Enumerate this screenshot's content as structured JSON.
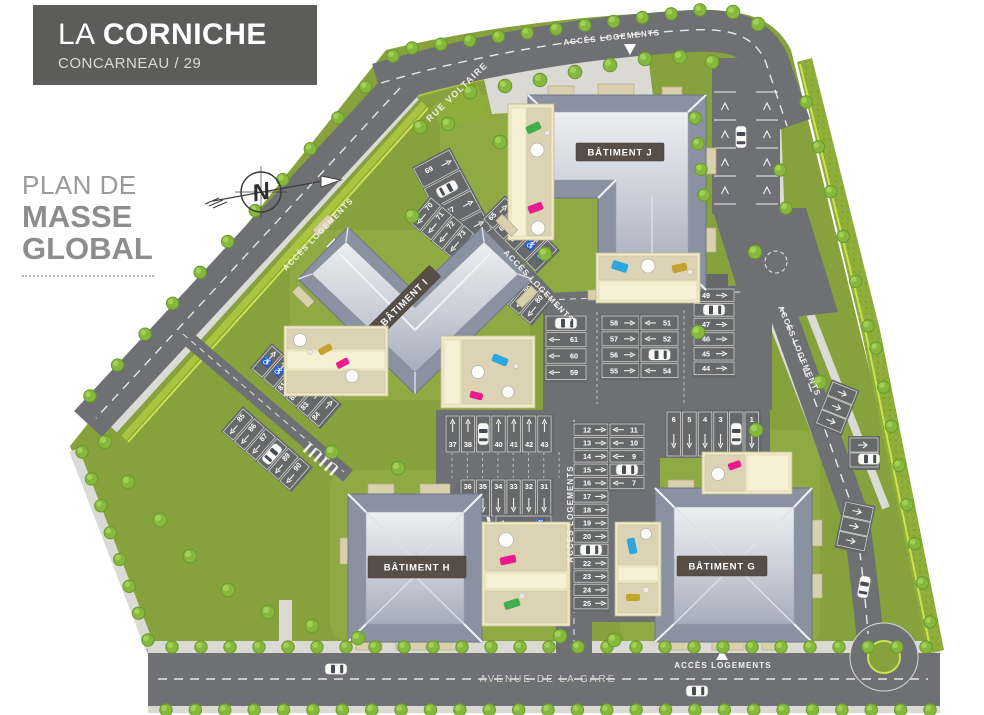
{
  "palette": {
    "grass": "#87a13c",
    "road": "#6f7073",
    "lot": "#66686a",
    "roofd": "#8a92a2",
    "terr": "#efe9c6",
    "hedge": "#a9c43f",
    "title-bg": "#5c5c5a",
    "label-bg": "#574e47"
  },
  "header": {
    "title_light": "LA",
    "title_bold": "CORNICHE",
    "subtitle": "CONCARNEAU / 29"
  },
  "plan_title": {
    "line1": "PLAN DE",
    "line2": "MASSE",
    "line3": "GLOBAL"
  },
  "compass": {
    "label": "N"
  },
  "streets": {
    "acces": "ACCÈS LOGEMENTS",
    "rue_voltaire": "RUE VOLTAIRE",
    "avenue": "AVENUE DE LA GARE"
  },
  "buildings": {
    "j": "BÂTIMENT J",
    "i": "BÂTIMENT I",
    "h": "BÂTIMENT H",
    "g": "BÂTIMENT G"
  },
  "parking": {
    "rv_row_a": [
      "69",
      "CAR",
      "67",
      "66"
    ],
    "rv_row_b": [
      "65",
      "64",
      "63",
      "HC",
      "HC"
    ],
    "rv_row_c": [
      "70",
      "71",
      "72",
      "73",
      "74",
      "75",
      "CAR",
      "77",
      "78",
      "79",
      "80"
    ],
    "sw_row_a": [
      "HC",
      "HC",
      "81",
      "82",
      "83",
      "84"
    ],
    "sw_row_b": [
      "85",
      "86",
      "87",
      "CAR",
      "89",
      "90"
    ],
    "central_left": [
      "CAR",
      "61",
      "60",
      "59"
    ],
    "central_mid_left": [
      "58",
      "57",
      "56",
      "55"
    ],
    "central_mid_right": [
      "51",
      "52",
      "CAR",
      "54"
    ],
    "central_right": [
      "49",
      "CAR",
      "47",
      "46",
      "45",
      "44"
    ],
    "stall_50": "50",
    "row_37_43": [
      "37",
      "38",
      "CAR",
      "40",
      "41",
      "42",
      "43"
    ],
    "row_36_31": [
      "36",
      "35",
      "34",
      "33",
      "32",
      "31"
    ],
    "col_30_26": [
      "HC",
      "30",
      "29",
      "28",
      "27",
      "26"
    ],
    "col_12_25": [
      "12",
      "13",
      "14",
      "15",
      "16",
      "17",
      "18",
      "19",
      "20",
      "CAR",
      "22",
      "23",
      "24",
      "25"
    ],
    "col_11_7": [
      "11",
      "10",
      "9",
      "CAR",
      "7"
    ],
    "row_6_1": [
      "6",
      "5",
      "4",
      "3",
      "CAR",
      "1"
    ]
  }
}
